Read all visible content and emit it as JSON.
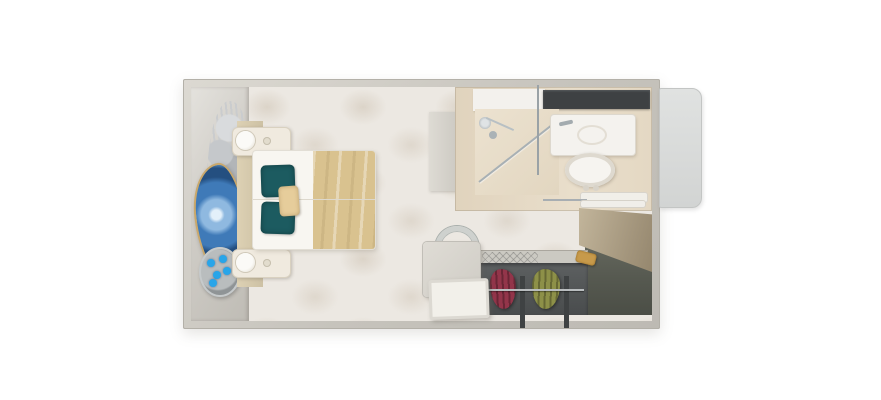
{
  "scene": {
    "kind": "cruise-stateroom-floorplan-render",
    "background": "#ffffff"
  },
  "colors": {
    "wall": "#c6c3bc",
    "carpet": "#ece8e2",
    "carpet_motif": "#cec3b3",
    "accent_art_wall": "#d5d2cc",
    "bed_linen": "#f8f6f1",
    "bed_runner": "#d9c28f",
    "pillow_teal": "#1c5b60",
    "accent_pillow": "#e6cd9b",
    "nightstand": "#f0eadf",
    "agate_blue": "#3f7ab8",
    "agate_rim_gold": "#c9a86c",
    "flower_blue": "#28a5e9",
    "planter_gray": "#9aa0a2",
    "tv_dark": "#2e3032",
    "bathroom_floor": "#e3d7c3",
    "fixture_white": "#f4f2ee",
    "mirror_dark": "#3e4143",
    "chrome": "#a3abaf",
    "entry_door_tan": "#ab9d82",
    "closet_interior": "#545758",
    "garment_red": "#93354a",
    "garment_green": "#8d9048",
    "gold": "#c79a4b",
    "desk_gray": "#d8d5ce",
    "door_panel_gray": "#dcdedd"
  },
  "items": [
    "double-bed-with-runner",
    "teal-pillows",
    "accent-pillow",
    "nightstand-with-lamp-top",
    "nightstand-with-lamp-bottom",
    "agate-wall-art",
    "silver-plant-sculpture",
    "planter-with-blue-flowers",
    "wall-mounted-tv",
    "bathroom-shower",
    "bathroom-sink-vanity",
    "bathroom-toilet",
    "bathroom-mirror-wall",
    "entry-door-open",
    "closet-with-hanging-clothes",
    "luggage-storage-area",
    "vanity-desk",
    "desk-chair",
    "side-table",
    "cabin-door-panel"
  ]
}
